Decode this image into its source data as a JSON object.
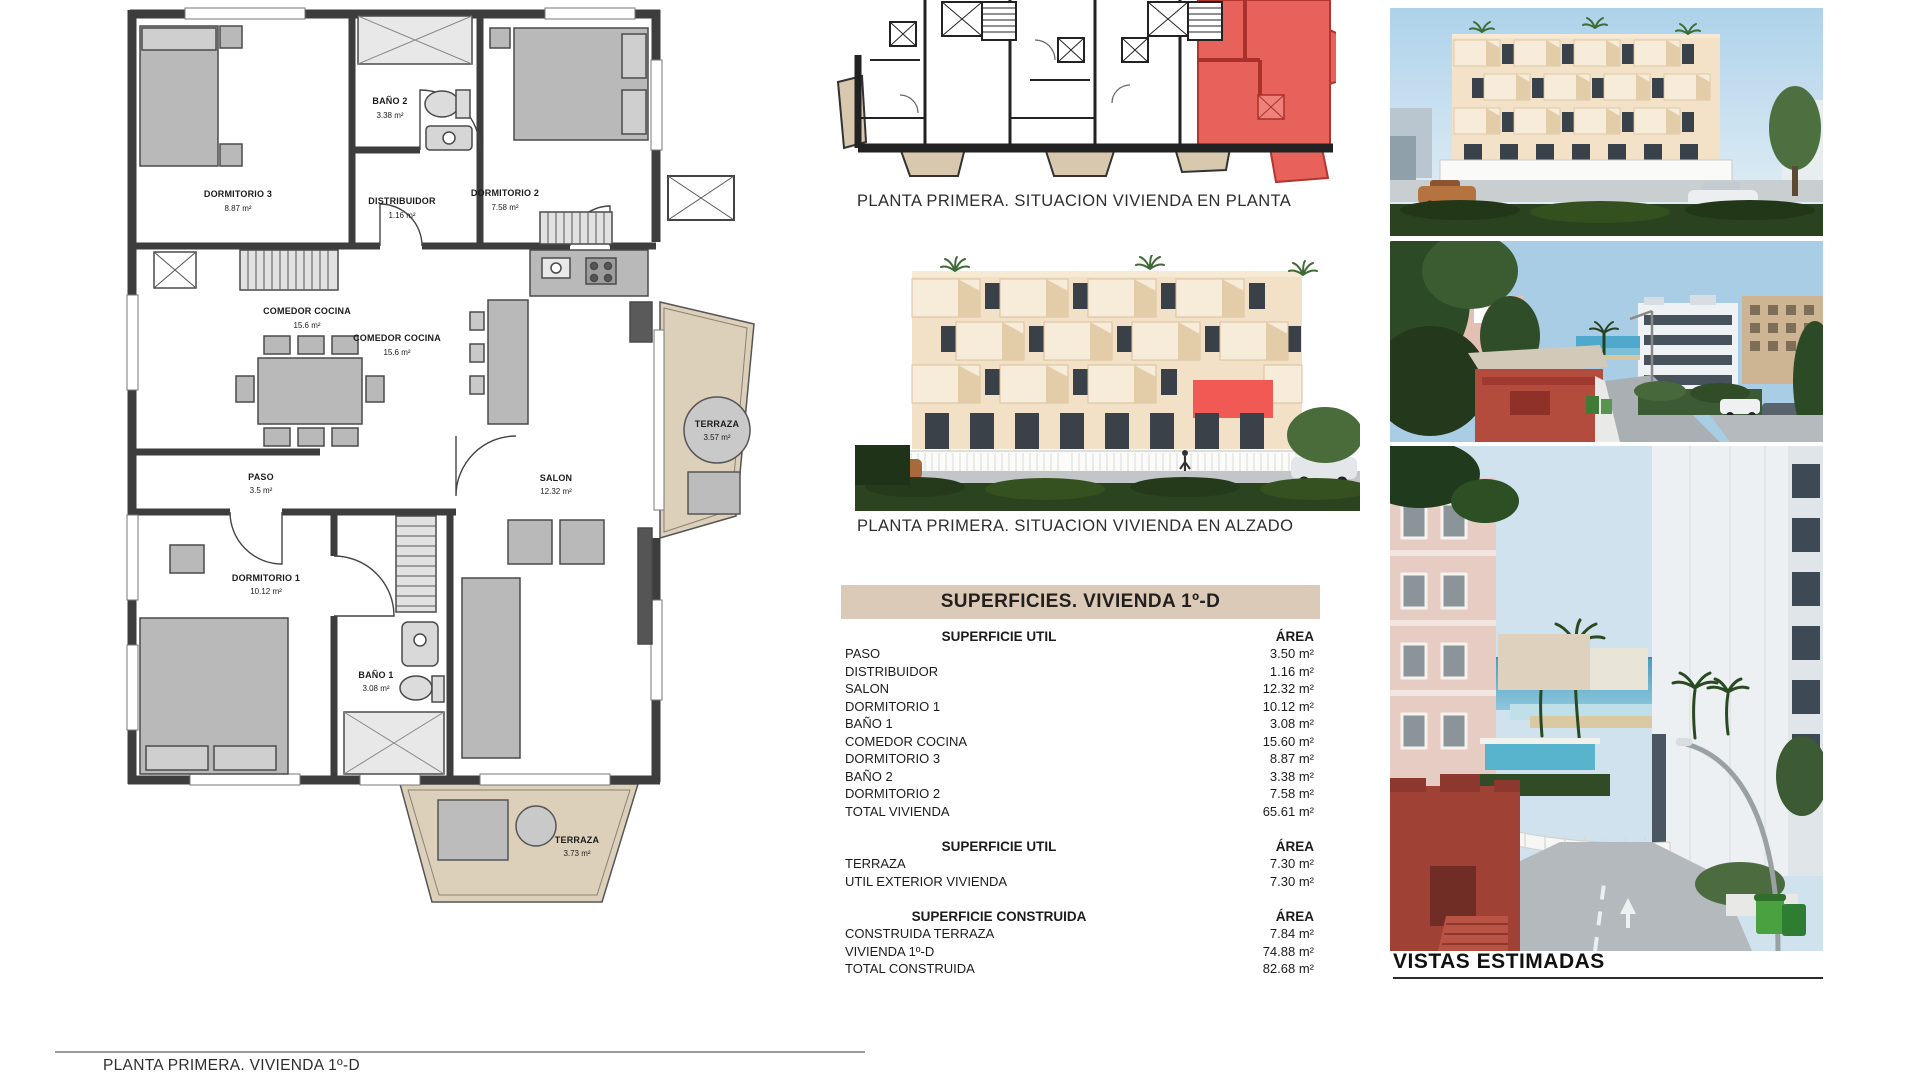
{
  "page": {
    "bottom_caption": "PLANTA PRIMERA. VIVIENDA 1º-D"
  },
  "key_plan": {
    "caption": "PLANTA PRIMERA. SITUACION VIVIENDA EN PLANTA"
  },
  "elevation": {
    "caption": "PLANTA PRIMERA. SITUACION VIVIENDA EN ALZADO"
  },
  "vistas": {
    "title": "VISTAS ESTIMADAS"
  },
  "floor_plan": {
    "rooms": [
      {
        "name": "DORMITORIO 3",
        "area": "8.87 m²"
      },
      {
        "name": "BAÑO 2",
        "area": "3.38 m²"
      },
      {
        "name": "DISTRIBUIDOR",
        "area": "1.16 m²"
      },
      {
        "name": "DORMITORIO 2",
        "area": "7.58 m²"
      },
      {
        "name": "COMEDOR COCINA",
        "area": "15.6 m²"
      },
      {
        "name": "COMEDOR COCINA",
        "area": "15.6 m²"
      },
      {
        "name": "TERRAZA",
        "area": "3.57 m²"
      },
      {
        "name": "PASO",
        "area": "3.5 m²"
      },
      {
        "name": "SALON",
        "area": "12.32 m²"
      },
      {
        "name": "DORMITORIO 1",
        "area": "10.12 m²"
      },
      {
        "name": "BAÑO 1",
        "area": "3.08 m²"
      },
      {
        "name": "TERRAZA",
        "area": "3.73 m²"
      }
    ]
  },
  "superficies": {
    "title": "SUPERFICIES. VIVIENDA 1º-D",
    "sections": [
      {
        "header": "SUPERFICIE UTIL",
        "area_header": "ÁREA",
        "rows": [
          {
            "label": "PASO",
            "value": "3.50 m²"
          },
          {
            "label": "DISTRIBUIDOR",
            "value": "1.16 m²"
          },
          {
            "label": "SALON",
            "value": "12.32 m²"
          },
          {
            "label": "DORMITORIO 1",
            "value": "10.12 m²"
          },
          {
            "label": "BAÑO 1",
            "value": "3.08 m²"
          },
          {
            "label": "COMEDOR COCINA",
            "value": "15.60 m²"
          },
          {
            "label": "DORMITORIO 3",
            "value": "8.87 m²"
          },
          {
            "label": "BAÑO 2",
            "value": "3.38 m²"
          },
          {
            "label": "DORMITORIO 2",
            "value": "7.58 m²"
          },
          {
            "label": "TOTAL VIVIENDA",
            "value": "65.61 m²"
          }
        ]
      },
      {
        "header": "SUPERFICIE UTIL",
        "area_header": "ÁREA",
        "rows": [
          {
            "label": "TERRAZA",
            "value": "7.30 m²"
          },
          {
            "label": "UTIL EXTERIOR VIVIENDA",
            "value": "7.30 m²"
          }
        ]
      },
      {
        "header": "SUPERFICIE CONSTRUIDA",
        "area_header": "ÁREA",
        "rows": [
          {
            "label": "CONSTRUIDA TERRAZA",
            "value": "7.84 m²"
          },
          {
            "label": "VIVIENDA 1º-D",
            "value": "74.88 m²"
          },
          {
            "label": "TOTAL CONSTRUIDA",
            "value": "82.68 m²"
          }
        ]
      }
    ]
  },
  "colors": {
    "highlight_red": "#e8605a",
    "terrace_tan": "#ddd0ba",
    "table_header_bg": "#dccab8",
    "wall_dark": "#3d3d3d",
    "furniture_gray": "#b9b9b9"
  }
}
